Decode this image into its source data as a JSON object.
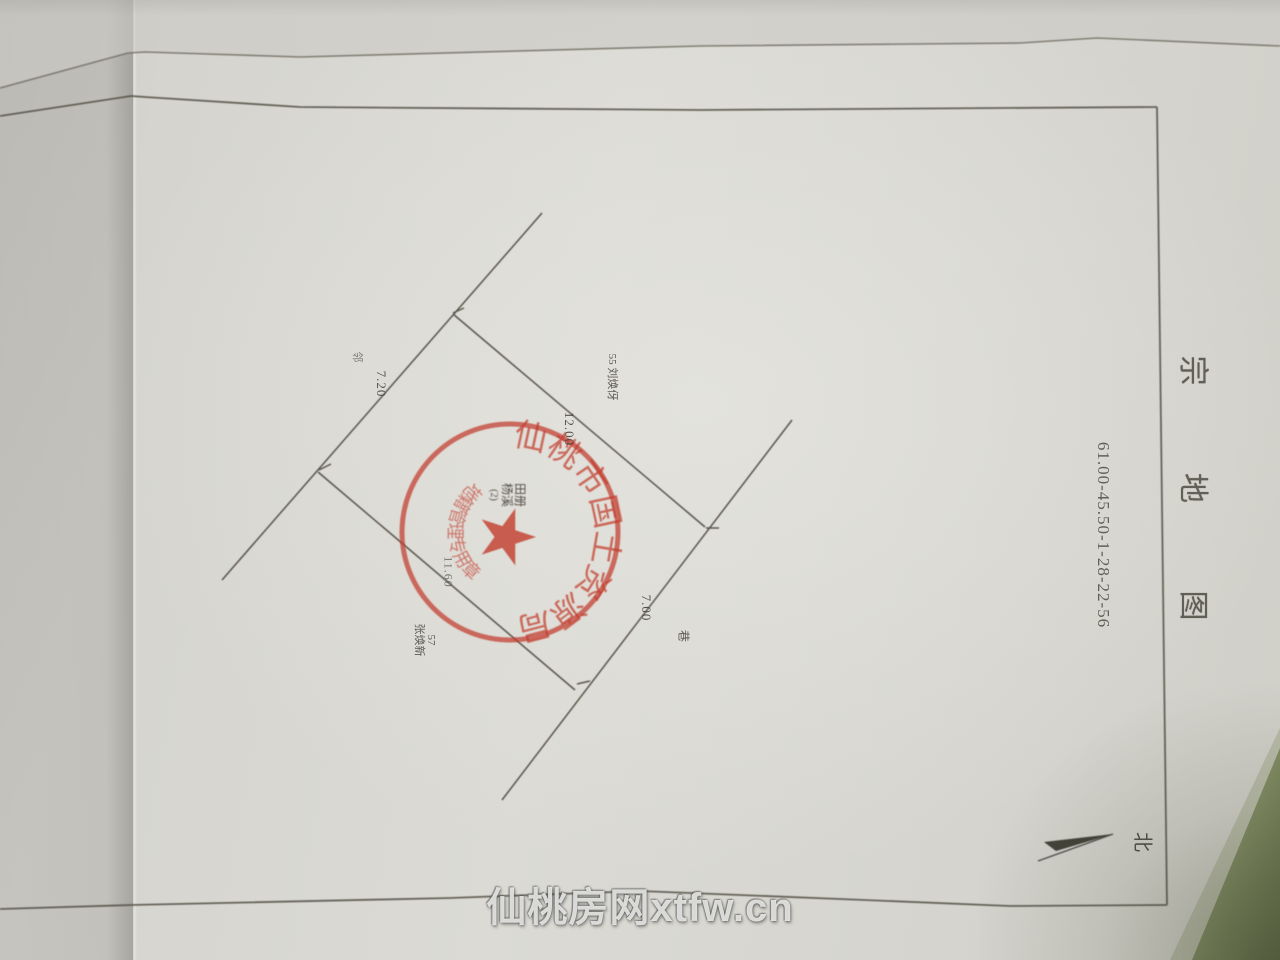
{
  "title_block": {
    "title": "宗 地 图",
    "sheet_number": "61.00-45.50-1-28-22-56"
  },
  "compass": {
    "north_label": "北"
  },
  "parcel": {
    "edge_top_right_len": "12.00",
    "edge_top_left_len": "7.20",
    "edge_bottom_right_len": "7.00",
    "edge_bottom_left_len": "11.60",
    "neighbor_right": "55 刘焕伢",
    "neighbor_bottom_no": "57",
    "neighbor_bottom_name": "张焕新",
    "mark_left_side": "邻",
    "mark_right_side": "巷"
  },
  "seal": {
    "outer_ring_text": "仙桃市国土资源局",
    "inner_arc_text": "地籍管理专用章",
    "center_line1": "田册",
    "center_line2": "杨溪",
    "center_line3": "(2)",
    "color": "#c23b2c"
  },
  "watermark": {
    "text": "仙桃房网xtfw.cn"
  },
  "colors": {
    "paper": "#d8d7d1",
    "ink": "#4b463c",
    "seal_red": "#c23b2c",
    "background_green": "#6a754e"
  }
}
